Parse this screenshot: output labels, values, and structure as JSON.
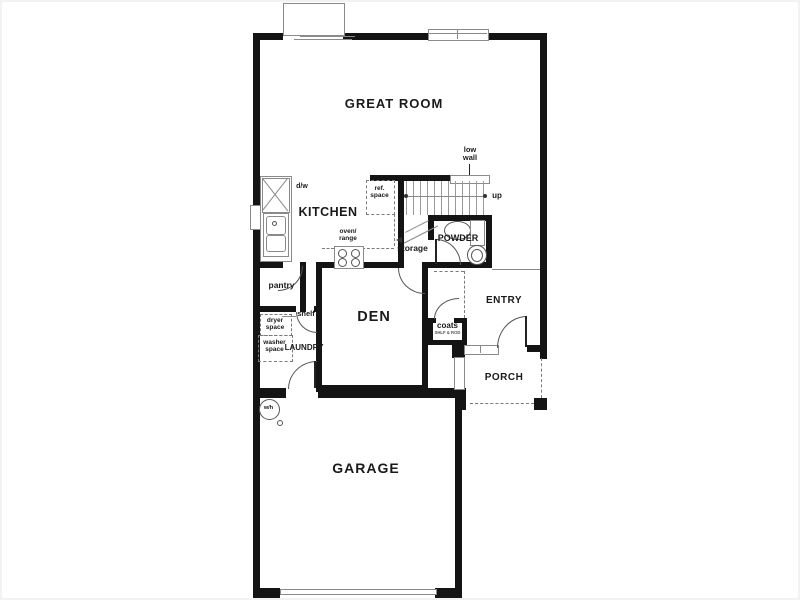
{
  "figure_type": "residential floor plan, first floor",
  "colors": {
    "wall": "#141414",
    "thin_line": "#8a8a8a",
    "dashed": "#7a7a7a",
    "text": "#1a1a1a",
    "background": "#ffffff"
  },
  "labels": {
    "great_room": "GREAT ROOM",
    "kitchen": "KITCHEN",
    "den": "DEN",
    "garage": "GARAGE",
    "entry": "ENTRY",
    "porch": "PORCH",
    "powder": "POWDER",
    "laundry": "LAUNDRY",
    "storage": "storage",
    "pantry": "pantry",
    "shelf": "shelf",
    "coats": "coats",
    "coats_note": "SHLF & ROD",
    "dw": "d/w",
    "wh": "w/h",
    "up": "up",
    "ref_1": "ref.",
    "ref_2": "space",
    "oven_1": "oven/",
    "oven_2": "range",
    "dryer_1": "dryer",
    "dryer_2": "space",
    "washer_1": "washer",
    "washer_2": "space",
    "low_1": "low",
    "low_2": "wall"
  }
}
